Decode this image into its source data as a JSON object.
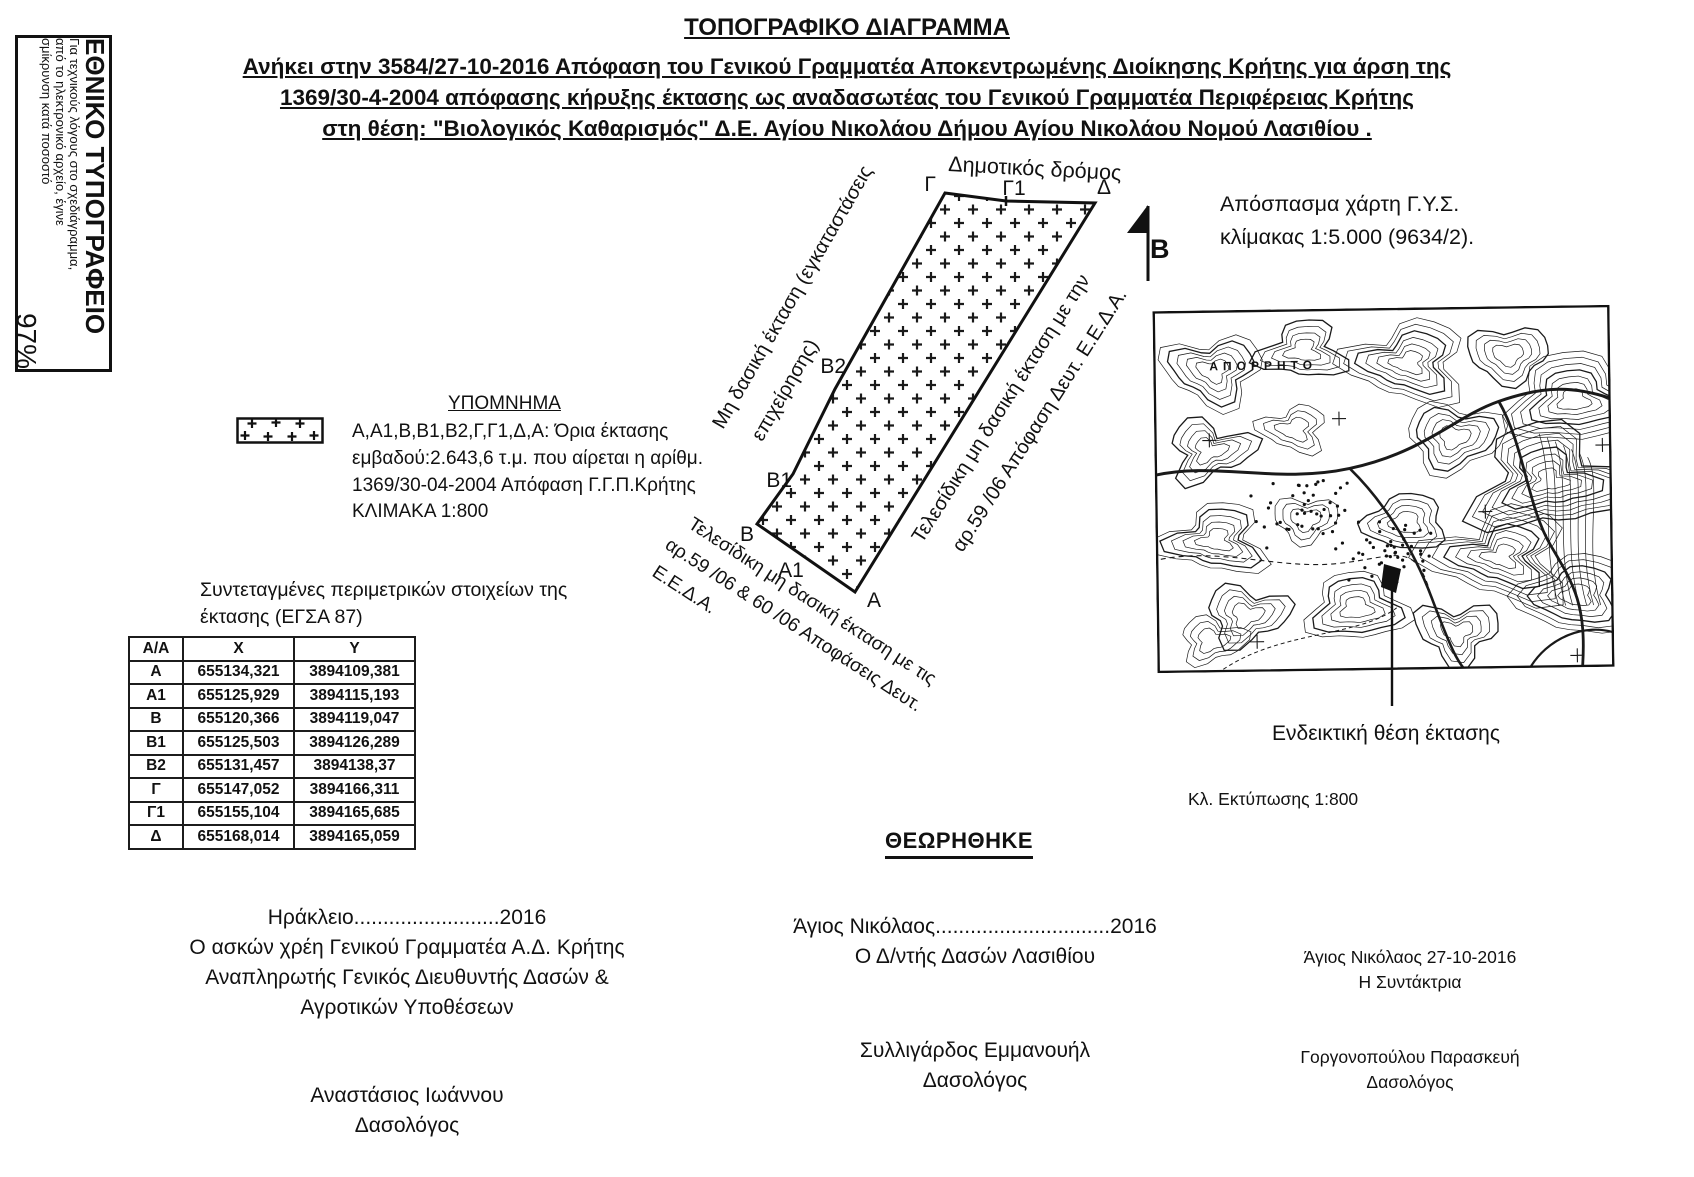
{
  "doc": {
    "title": "ΤΟΠΟΓΡΑΦΙΚΟ ΔΙΑΓΡΑΜΜΑ",
    "subtitle_lines": [
      "Ανήκει  στην  3584/27-10-2016 Απόφαση του Γενικού Γραμματέα Αποκεντρωμένης Διοίκησης Κρήτης για άρση της",
      "1369/30-4-2004 απόφασης κήρυξης έκτασης ως αναδασωτέας του Γενικού Γραμματέα Περιφέρειας Κρήτης",
      "στη θέση: \"Βιολογικός Καθαρισμός\" Δ.Ε. Αγίου Νικολάου Δήμου Αγίου Νικολάου Νομού Λασιθίου ."
    ]
  },
  "side_stamp": {
    "org": "ΕΘΝΙΚΟ ΤΥΠΟΓΡΑΦΕΙΟ",
    "note_line1": "Για τεχνικούς λόγους στο σχεδιάγραμμα,",
    "note_line2": "από το ηλεκτρονικό αρχείο, έγινε",
    "note_line3": "σμίκρυνση κατά ποσοστό",
    "percent": "97%"
  },
  "legend": {
    "title": "ΥΠΟΜΝΗΜΑ",
    "lines": [
      "Α,Α1,Β,Β1,Β2,Γ,Γ1,Δ,Α: Όρια έκτασης",
      "εμβαδού:2.643,6 τ.μ. που αίρεται  η αρίθμ.",
      "1369/30-04-2004 Απόφαση Γ.Γ.Π.Κρήτης",
      "ΚΛΙΜΑΚΑ 1:800"
    ]
  },
  "coords_table": {
    "title_line1": "Συντεταγμένες περιμετρικών στοιχείων της",
    "title_line2": "έκτασης (ΕΓΣΑ 87)",
    "headers": [
      "Α/Α",
      "Χ",
      "Υ"
    ],
    "rows": [
      [
        "Α",
        "655134,321",
        "3894109,381"
      ],
      [
        "Α1",
        "655125,929",
        "3894115,193"
      ],
      [
        "Β",
        "655120,366",
        "3894119,047"
      ],
      [
        "Β1",
        "655125,503",
        "3894126,289"
      ],
      [
        "Β2",
        "655131,457",
        "3894138,37"
      ],
      [
        "Γ",
        "655147,052",
        "3894166,311"
      ],
      [
        "Γ1",
        "655155,104",
        "3894165,685"
      ],
      [
        "Δ",
        "655168,014",
        "3894165,059"
      ]
    ]
  },
  "parcel": {
    "road_label": "Δημοτικός δρόμος",
    "north_label": "Β",
    "vertices": [
      "Γ",
      "Γ1",
      "Δ",
      "Β2",
      "Β1",
      "Β",
      "Α1",
      "Α"
    ],
    "left_note": [
      "Μη δασική έκταση (εγκαταστάσεις",
      "επιχείρησης)"
    ],
    "right_note": [
      "Τελεσίδικη μη δασική έκταση με την",
      "αρ.59 /06 Απόφαση Δευτ. Ε.Ε.Δ.Α."
    ],
    "bottom_note": [
      "Τελεσίδικη μη δασική έκταση με τις",
      "αρ.59 /06 & 60 /06 Αποφάσεις Δευτ.",
      "Ε.Ε.Δ.Α."
    ]
  },
  "map_panel": {
    "caption_line1": "Απόσπασμα χάρτη Γ.Υ.Σ.",
    "caption_line2": "κλίμακας 1:5.000 (9634/2).",
    "map_stamp": "ΑΠΟΡΡΗΤΟ",
    "pointer_label": "Ενδεικτική θέση έκτασης",
    "print_scale": "Κλ. Εκτύπωσης 1:800"
  },
  "approval": {
    "reviewed": "ΘΕΩΡΗΘΗΚΕ",
    "left": {
      "line1": "Ηράκλειο.........................2016",
      "line2": "Ο  ασκών χρέη Γενικού Γραμματέα Α.Δ. Κρήτης",
      "line3": "Αναπληρωτής Γενικός Διευθυντής  Δασών &",
      "line4": "Αγροτικών Υποθέσεων",
      "name": "Αναστάσιος Ιωάννου",
      "role": "Δασολόγος"
    },
    "middle": {
      "line1": "Άγιος Νικόλαος..............................2016",
      "line2": "Ο Δ/ντής Δασών Λασιθίου",
      "name": "Συλλιγάρδος Εμμανουήλ",
      "role": "Δασολόγος"
    },
    "right": {
      "line1": "Άγιος Νικόλαος    27-10-2016",
      "line2": "Η Συντάκτρια",
      "name": "Γοργονοπούλου Παρασκευή",
      "role": "Δασολόγος"
    }
  },
  "colors": {
    "ink": "#111111",
    "paper": "#ffffff"
  }
}
